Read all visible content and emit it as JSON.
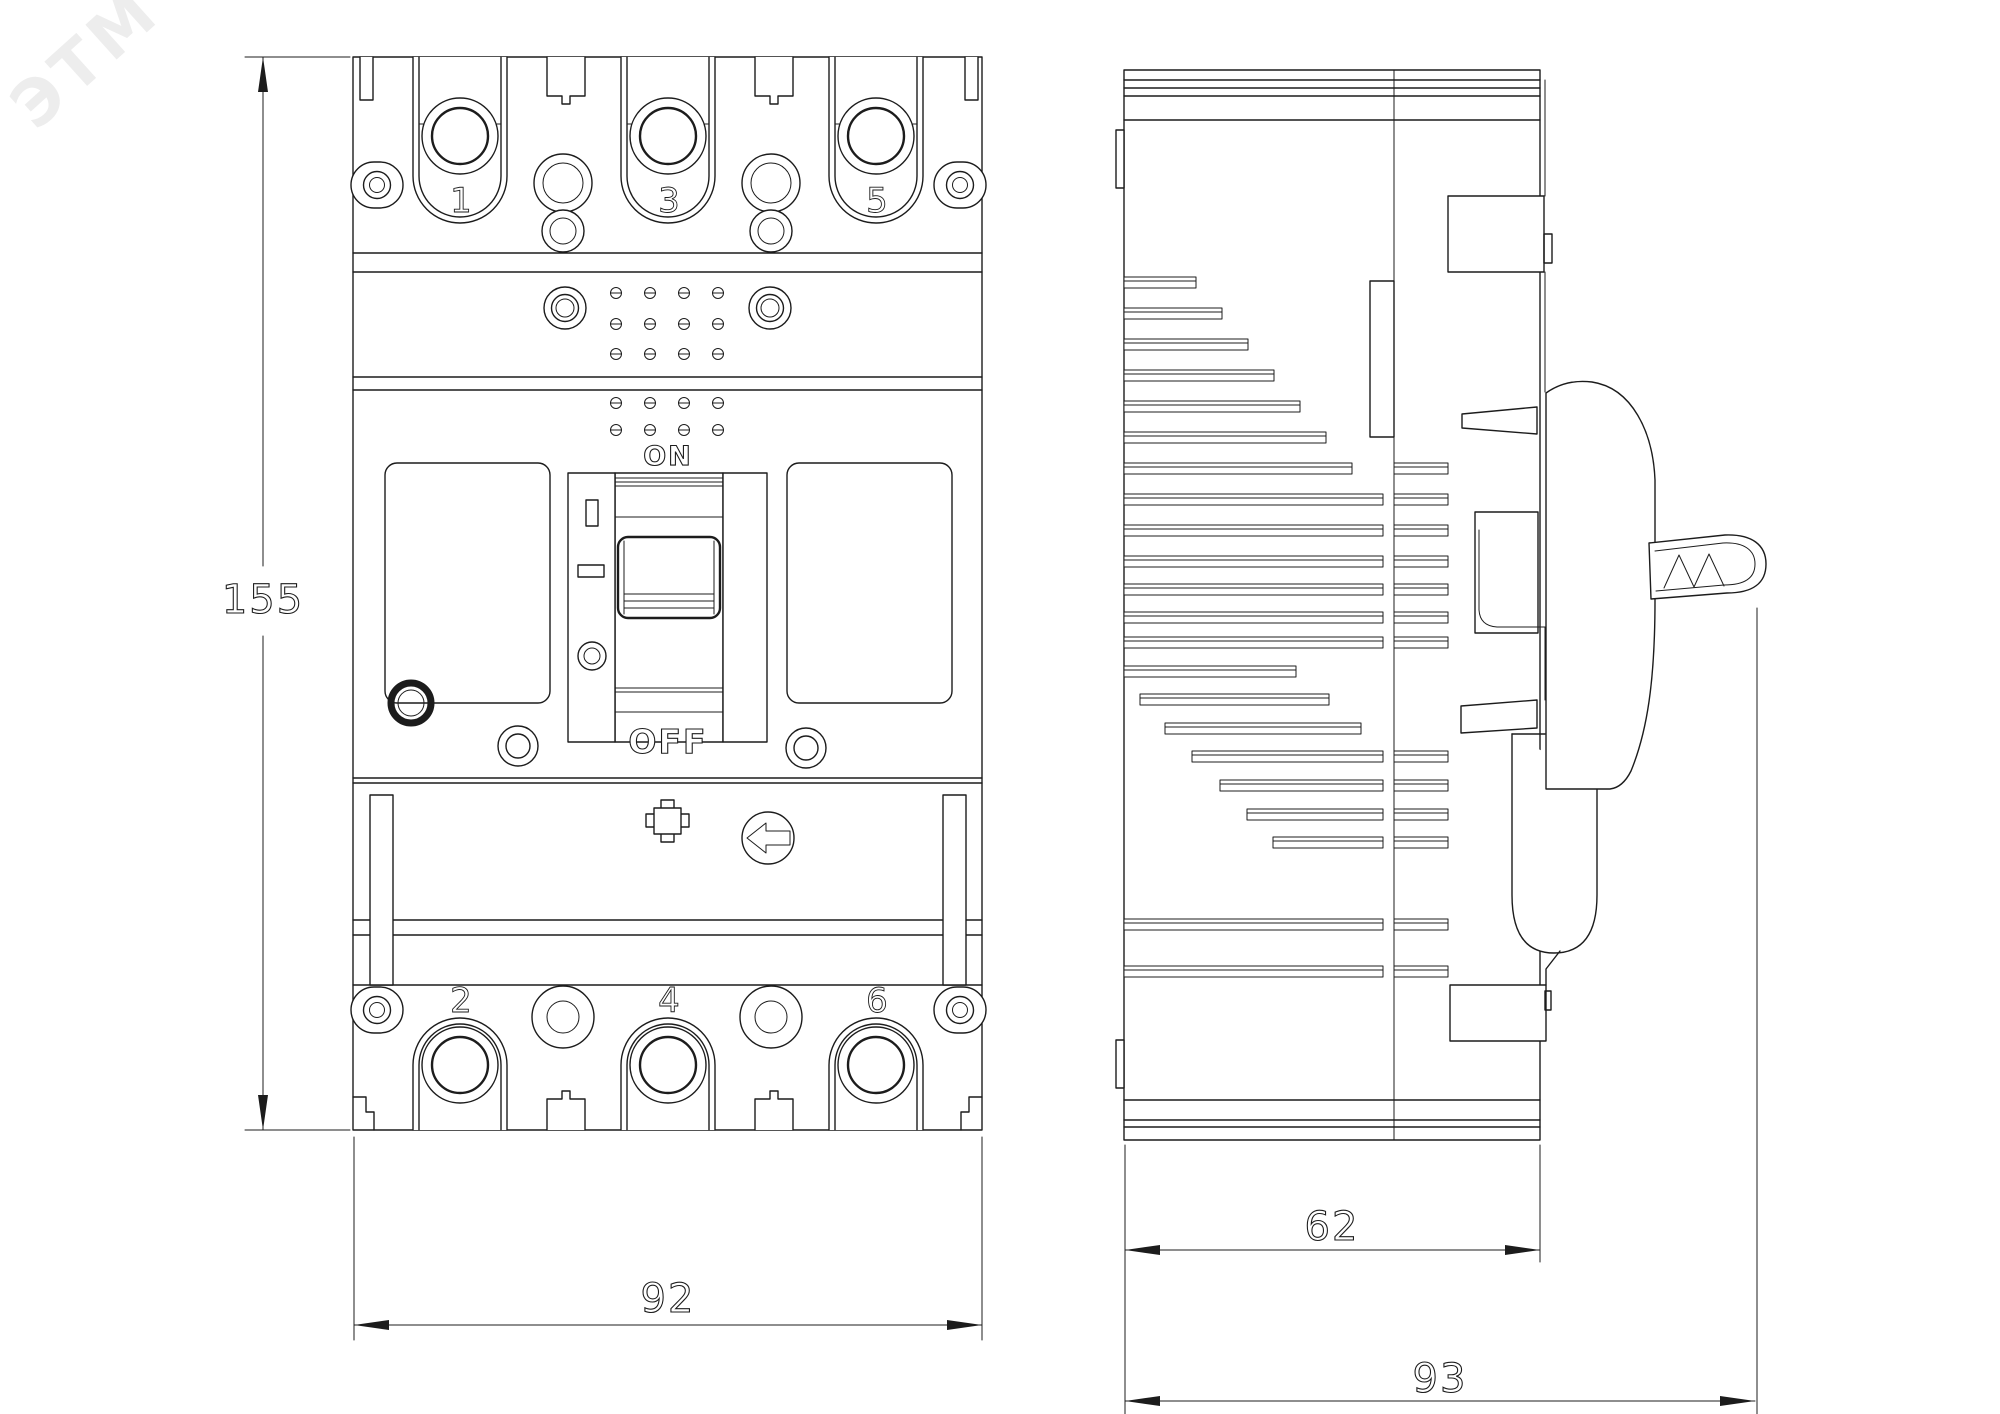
{
  "watermark": {
    "text": "ЭТМ"
  },
  "front_view": {
    "top_terminal_labels": [
      "1",
      "3",
      "5"
    ],
    "bottom_terminal_labels": [
      "2",
      "4",
      "6"
    ],
    "switch_on_label": "ON",
    "switch_off_label": "OFF"
  },
  "dimensions": {
    "height": "155",
    "width": "92",
    "body_depth": "62",
    "total_depth": "93"
  },
  "colors": {
    "line": "#1c1c1c",
    "background": "#ffffff",
    "watermark": "#ededed"
  }
}
